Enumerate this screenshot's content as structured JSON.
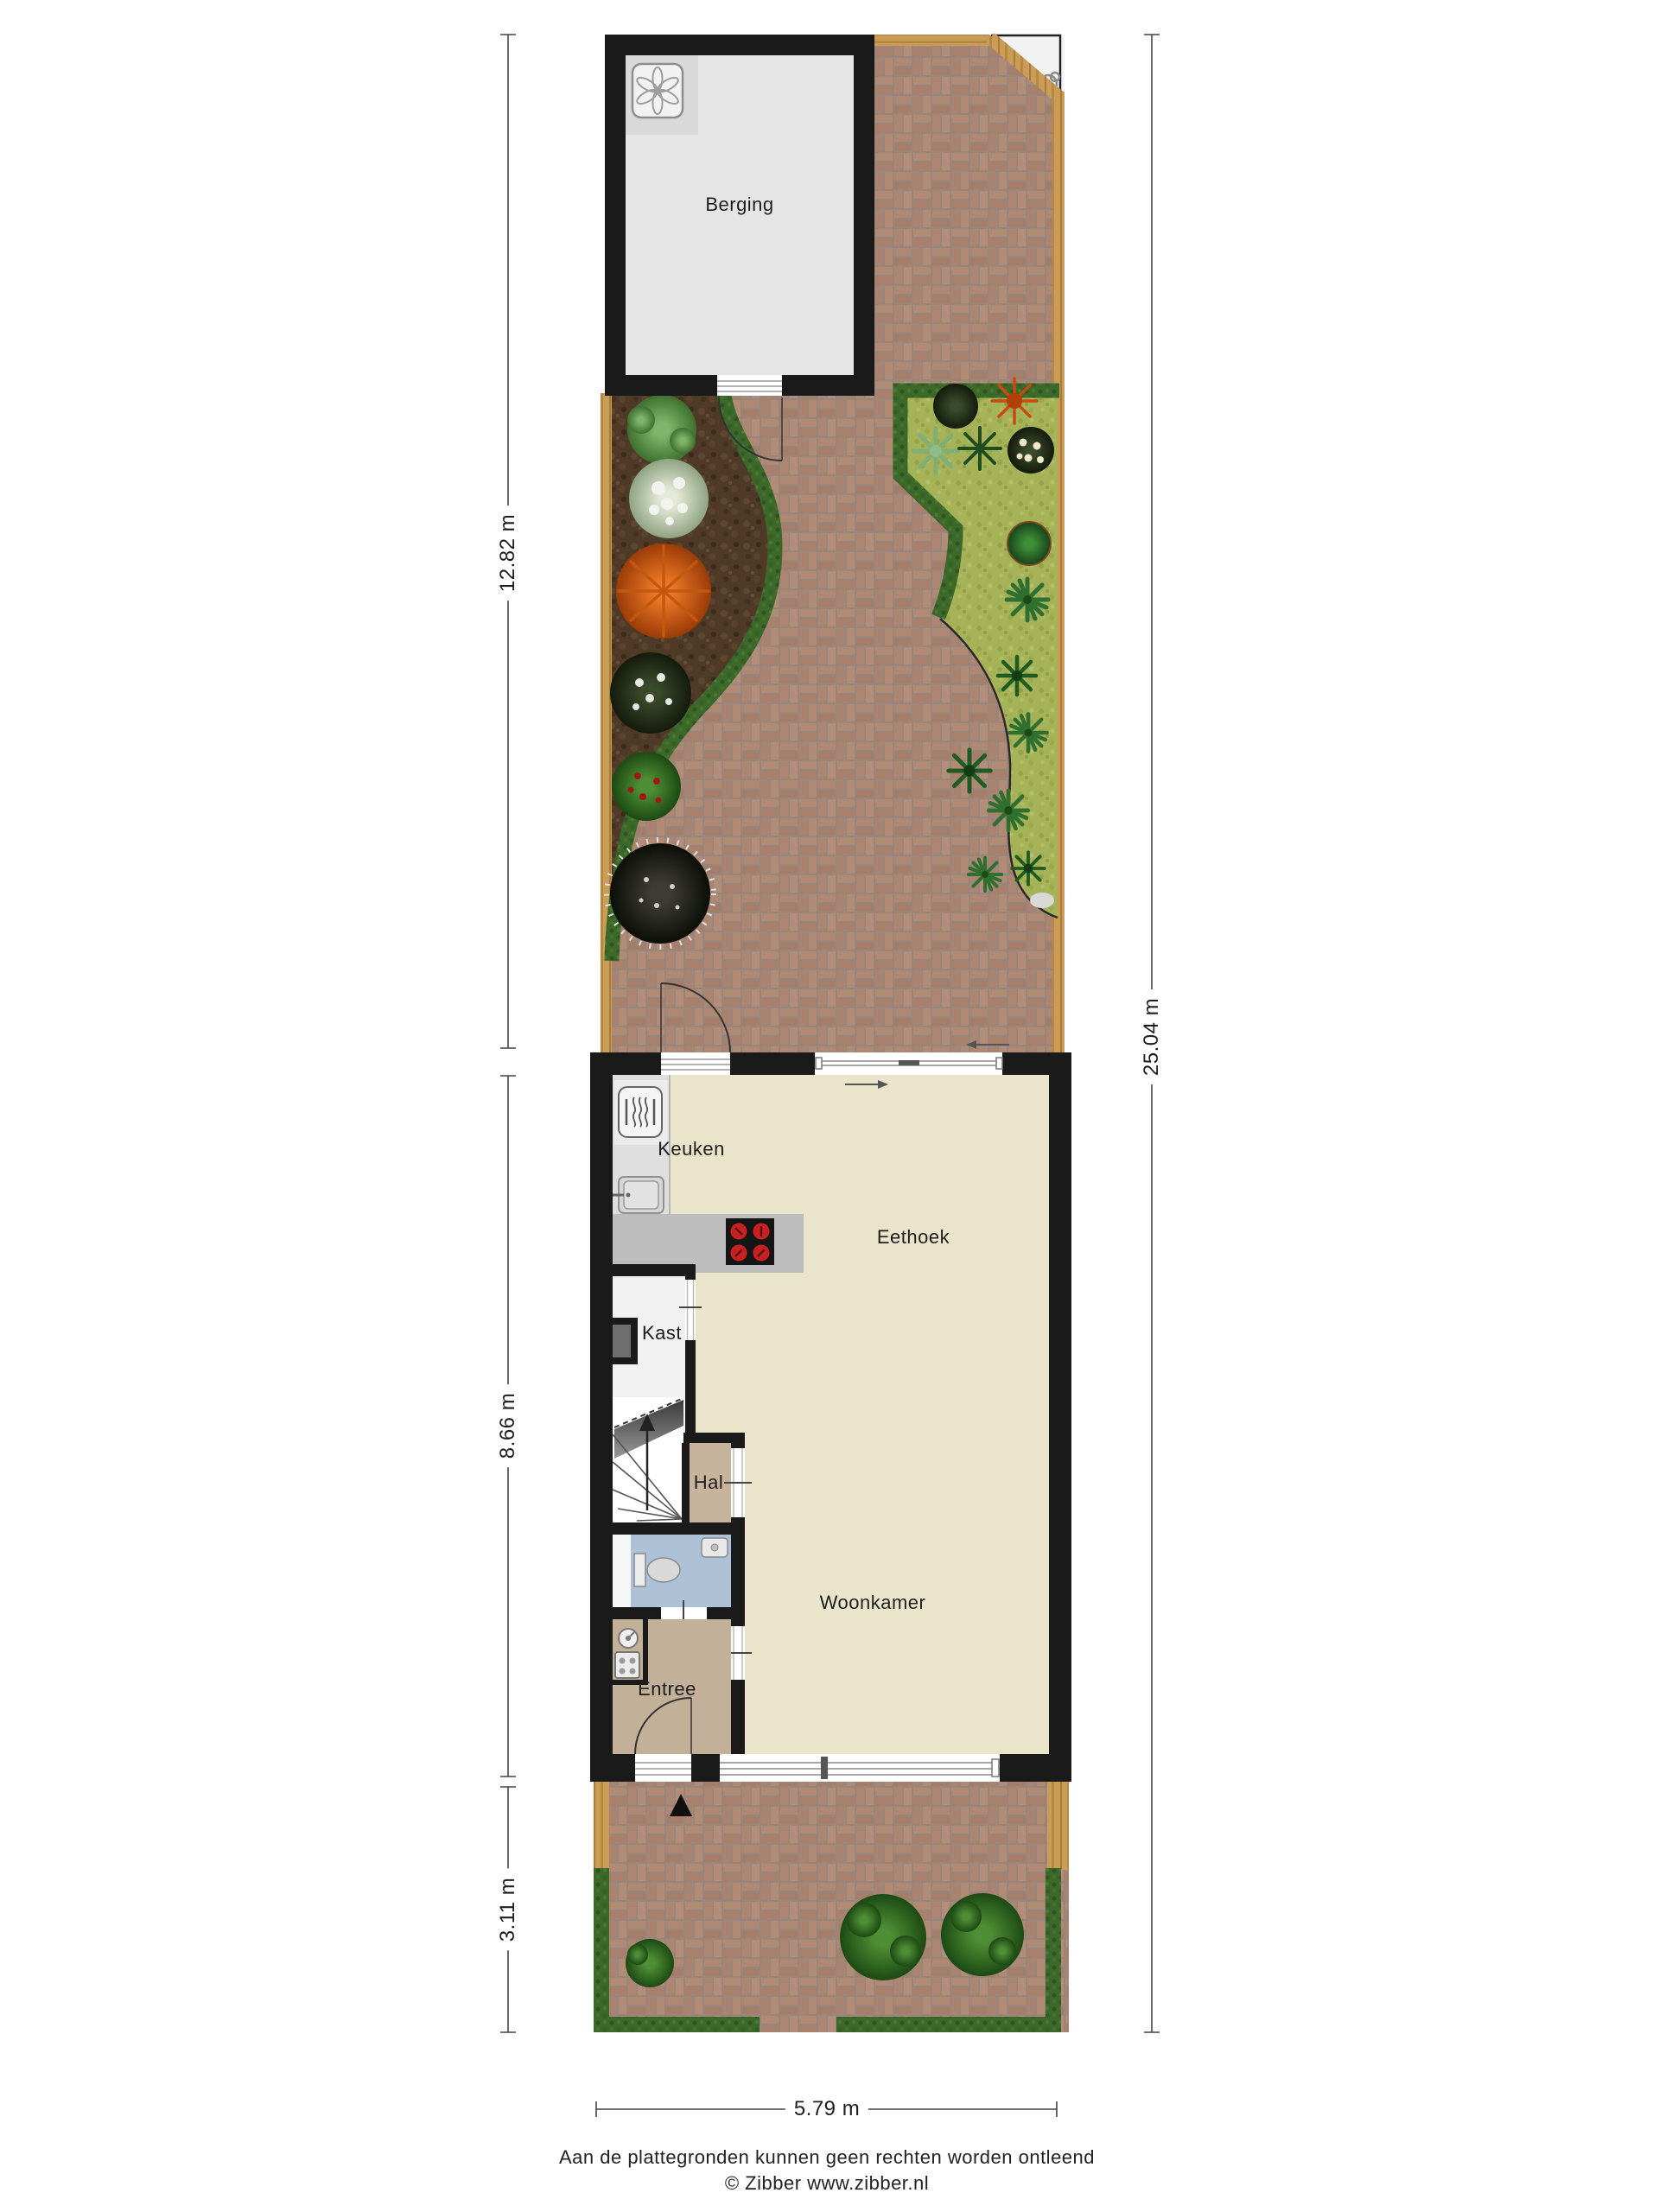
{
  "title": "Begane grond plattegrond met tuin",
  "rooms": {
    "berging": "Berging",
    "keuken": "Keuken",
    "eethoek": "Eethoek",
    "kast": "Kast",
    "hal": "Hal",
    "woonkamer": "Woonkamer",
    "entree": "Entree"
  },
  "dimensions": {
    "garden_depth": "12.82 m",
    "house_depth": "8.66 m",
    "front_garden_depth": "3.11 m",
    "total_depth": "25.04 m",
    "plot_width": "5.79 m"
  },
  "footer": {
    "disclaimer": "Aan de plattegronden kunnen geen rechten worden ontleend",
    "copyright": "© Zibber www.zibber.nl"
  },
  "icons": [
    "washing-machine-icon",
    "heater-icon",
    "kitchen-sink-icon",
    "cooktop-icon",
    "toilet-icon",
    "wc-sink-icon",
    "stairs-up-icon",
    "electric-meter-icon",
    "gas-meter-icon",
    "entrance-triangle-icon",
    "door-swing-arc",
    "sliding-window-arrow",
    "corner-shrub-icon"
  ],
  "colors": {
    "wall": "#1a1a1a",
    "floor_main": "#eae4cb",
    "floor_hal": "#c8b49c",
    "floor_entree": "#c3b098",
    "floor_wc": "#adc2d6",
    "floor_kast": "#f1f1f1",
    "floor_berging": "#e5e5e5",
    "brick": "#ab8878",
    "wood_edge": "#c99c58",
    "soil": "#4e3a27",
    "grass": "#a6b257",
    "hedge": "#3c682a",
    "counter": "#bdbdbd",
    "burner_red": "#c92121"
  }
}
